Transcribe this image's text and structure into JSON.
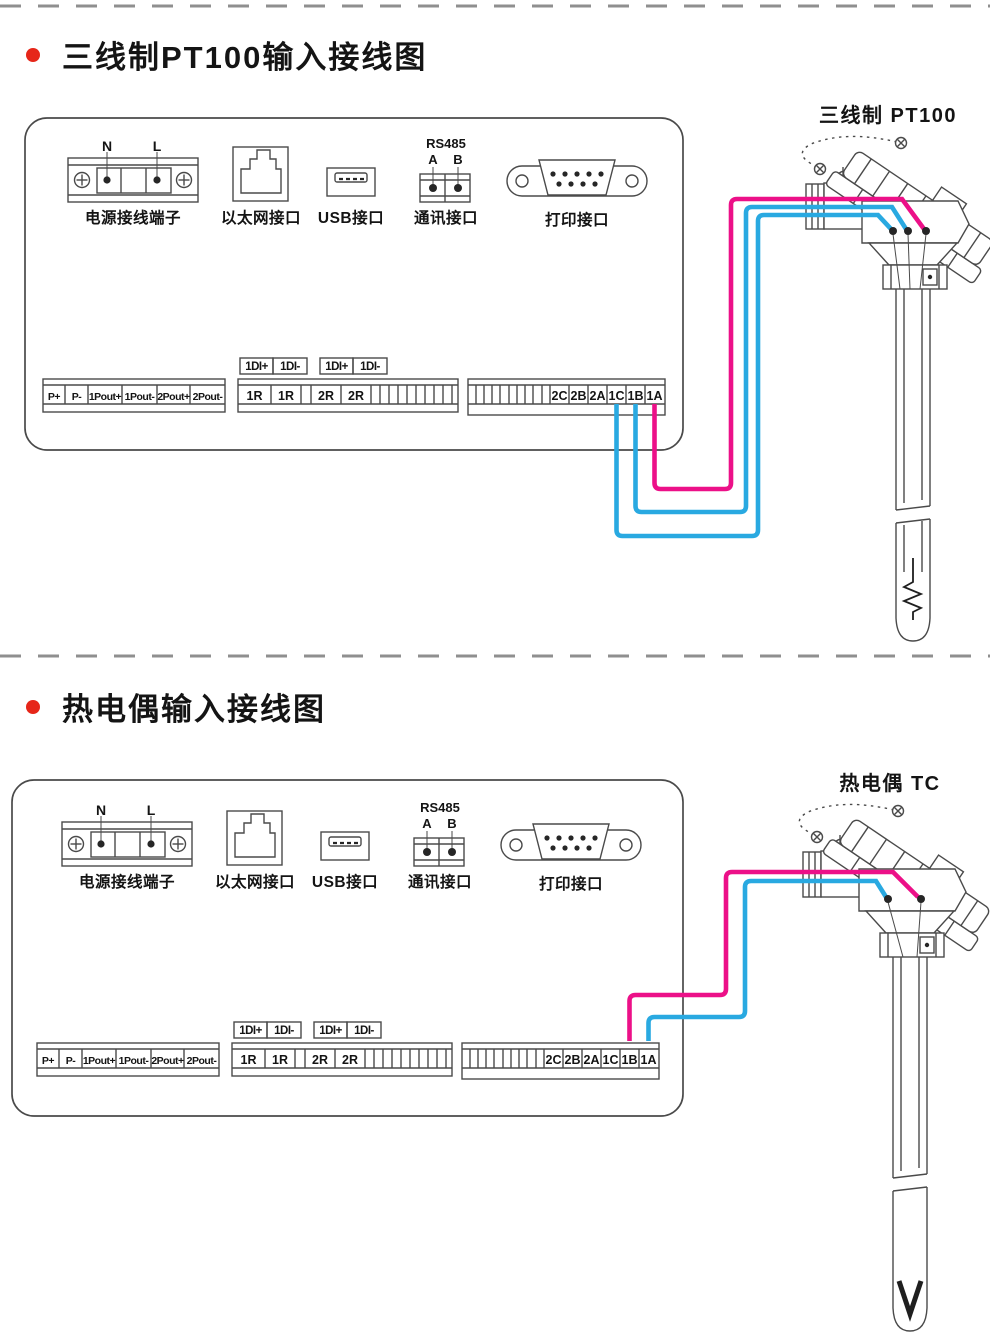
{
  "colors": {
    "wire_hot": "#ec1088",
    "wire_cold": "#29a9e1",
    "ink": "#4a4a4a",
    "dash": "#8f8f8f",
    "bullet_red": "#e62619",
    "text": "#141414"
  },
  "panel": {
    "power": {
      "n": "N",
      "l": "L",
      "label": "电源接线端子"
    },
    "ethernet": {
      "label": "以太网接口"
    },
    "usb": {
      "label": "USB接口"
    },
    "comm": {
      "title": "RS485",
      "a": "A",
      "b": "B",
      "label": "通讯接口"
    },
    "printer": {
      "label": "打印接口"
    },
    "strip_power_out": [
      "P+",
      "P-",
      "1Pout+",
      "1Pout-",
      "2Pout+",
      "2Pout-"
    ],
    "di_labels": [
      "1DI+",
      "1DI-",
      "1DI+",
      "1DI-"
    ],
    "strip_relay": [
      "1R",
      "1R",
      "2R",
      "2R"
    ],
    "strip_input": [
      "2C",
      "2B",
      "2A",
      "1C",
      "1B",
      "1A"
    ]
  },
  "sections": [
    {
      "title": "三线制PT100输入接线图",
      "sensor": {
        "label": "三线制 PT100",
        "tip_symbol": "rtd-resistance-element",
        "tip_d": "M 913 558 L 913 582 L 904 587 L 921 594 L 904 601 L 921 608 L 913 612 L 913 620"
      },
      "wires": [
        {
          "from": "1C",
          "to": "sensor-terminal-left",
          "color": "cold",
          "d": "M 616.5 404 L 616.5 530 Q 616.5 536 622.5 536 L 752 536 Q 758 536 758 530 L 758 221 Q 758 215 764 215 L 878 215 L 891 229"
        },
        {
          "from": "1B",
          "to": "sensor-terminal-middle",
          "color": "cold",
          "d": "M 635.5 404 L 635.5 506 Q 635.5 512 641.5 512 L 740 512 Q 746 512 746 506 L 746 213 Q 746 207 752 207 L 892 207 L 906 229"
        },
        {
          "from": "1A",
          "to": "sensor-terminal-right",
          "color": "hot",
          "d": "M 654.5 404 L 654.5 483 Q 654.5 489 660.5 489 L 725 489 Q 731 489 731 483 L 731 205 Q 731 199 737 199 L 902 199 L 924 229"
        }
      ]
    },
    {
      "title": "热电偶输入接线图",
      "sensor": {
        "label": "热电偶 TC",
        "tip_symbol": "tc-junction",
        "tip_d": "M 899 621 L 910 654 L 921 621"
      },
      "wires": [
        {
          "from": "1B",
          "to": "sensor-terminal-right",
          "color": "hot",
          "d": "M 629.5 381 L 629.5 341 Q 629.5 335 635.5 335 L 720 335 Q 726 335 726 329 L 726 218 Q 726 212 732 212 L 893 212 L 918 237"
        },
        {
          "from": "1A",
          "to": "sensor-terminal-left",
          "color": "cold",
          "d": "M 648.5 381 L 648.5 363 Q 648.5 357 654.5 357 L 739 357 Q 745 357 745 351 L 745 227 Q 745 221 751 221 L 876 221 L 886 237"
        }
      ]
    }
  ]
}
